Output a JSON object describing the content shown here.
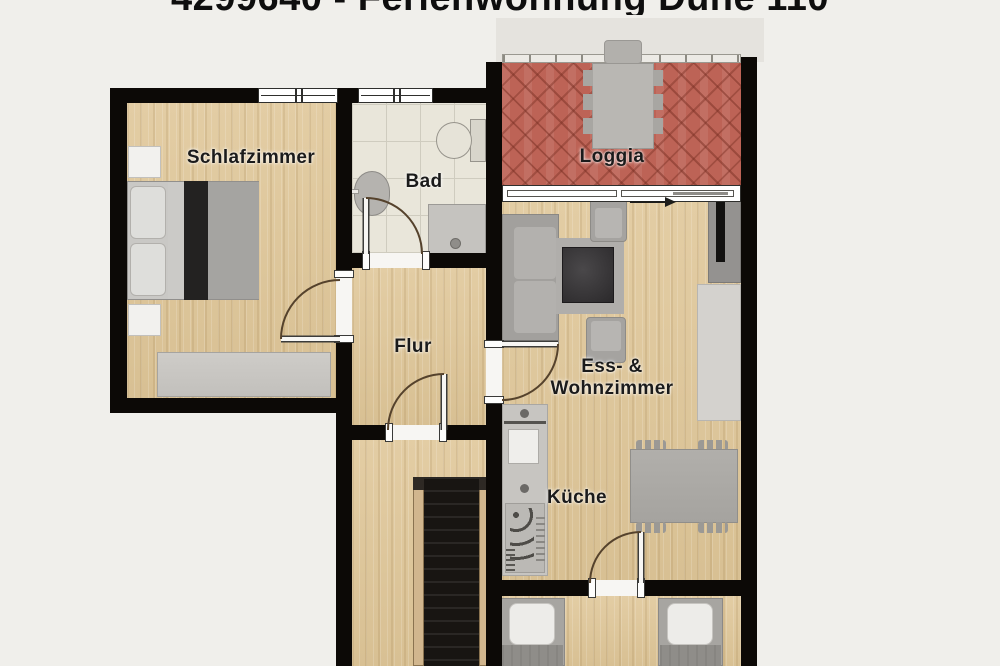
{
  "title": "4299640 - Ferienwohnung Düne 110",
  "rooms": {
    "schlafzimmer": "Schlafzimmer",
    "bad": "Bad",
    "loggia": "Loggia",
    "flur": "Flur",
    "wohnzimmer_line1": "Ess- &",
    "wohnzimmer_line2": "Wohnzimmer",
    "kueche": "Küche"
  },
  "colors": {
    "background": "#f0efeb",
    "wall": "#0c0906",
    "wood_floor": "#ddc79d",
    "bath_tile_floor": "#e9e6da",
    "loggia_brick_floor": "#bd6356",
    "furniture_gray": "#a7a5a2",
    "label_text": "#1b1b1b"
  }
}
